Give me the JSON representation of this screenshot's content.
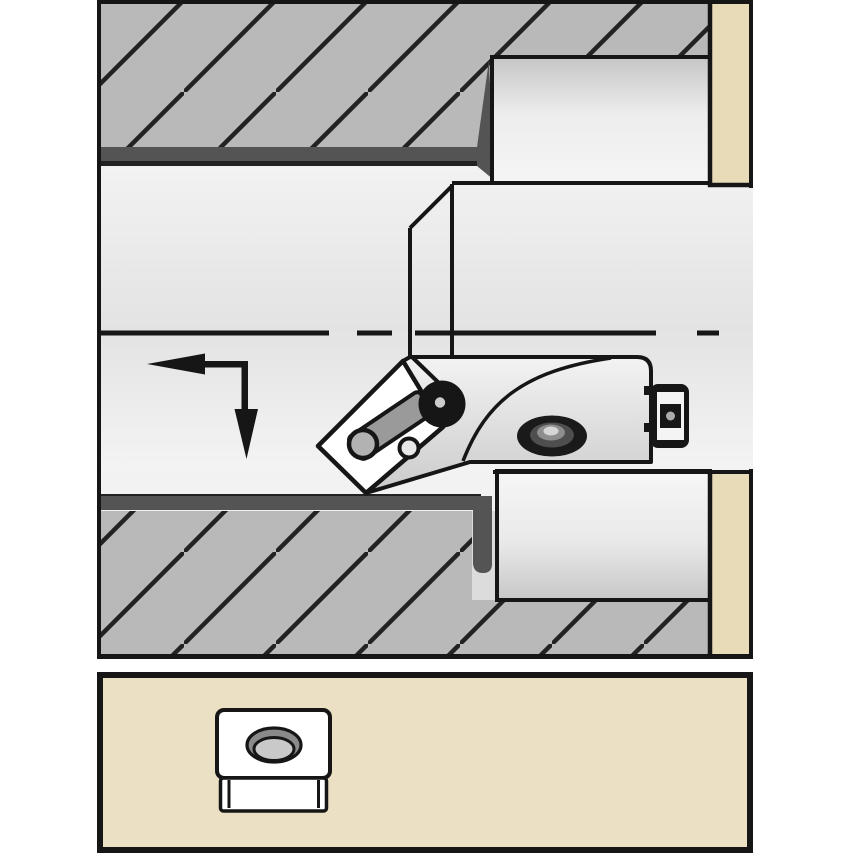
{
  "figure": {
    "kind": "technical-illustration",
    "subject": "internal boring operation cross-section: tool head with clamped indexable insert machining a stepped bore, with insert shape detail panel below",
    "main_panel": {
      "elements": [
        "workpiece-upper-wall",
        "workpiece-lower-wall",
        "bore-wall-surface",
        "counterbore-upper-wall",
        "counterbore-lower-wall",
        "workpiece-end-face",
        "bore-centerline",
        "feed-direction-arrow",
        "boring-tool-head",
        "indexable-insert",
        "insert-hole",
        "insert-clamp",
        "clamp-pivot",
        "clamp-screw-head",
        "clamp-screw-side-view",
        "cartridge-end-screw"
      ]
    },
    "bottom_panel": {
      "elements": [
        "insert-shape-icon"
      ]
    },
    "symbols": [
      "section-hatching",
      "centerline-dash-dot",
      "feed-direction-arrow"
    ]
  },
  "colors": {
    "page_bg": "#ffffff",
    "ink": "#161616",
    "hatch_fill": "#b9b9b9",
    "hatch_line": "#222222",
    "bore_wall_dark": "#545454",
    "workpiece_face_tan": "#e8dbb8",
    "panel_bg": "#ebe0c4",
    "steel_light": "#f3f3f3",
    "steel_dark": "#cbcbcb",
    "insert_white": "#ffffff",
    "clamp_gray": "#9a9a9a",
    "pivot_gray": "#b2b2b2",
    "screw_dot_gray": "#cccccc"
  }
}
